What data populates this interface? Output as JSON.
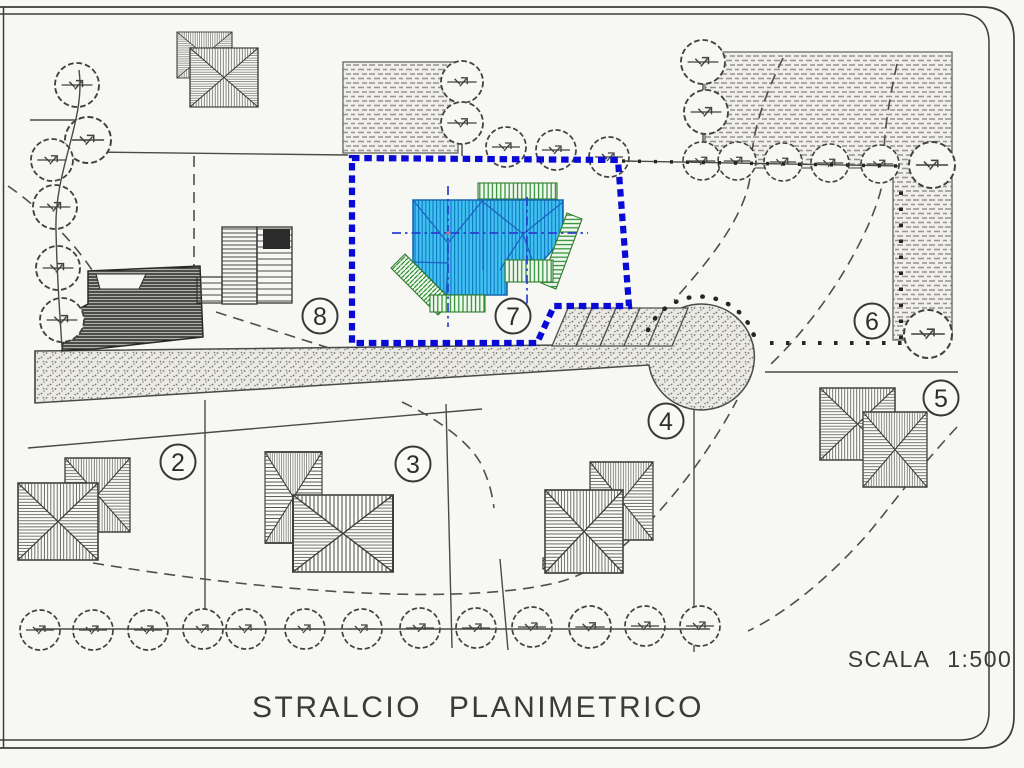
{
  "title": "STRALCIO PLANIMETRICO",
  "scale_label": "SCALA 1:500",
  "highlighted_lot": "7",
  "lots": [
    {
      "label": "2"
    },
    {
      "label": "3"
    },
    {
      "label": "4"
    },
    {
      "label": "5"
    },
    {
      "label": "6"
    },
    {
      "label": "7"
    },
    {
      "label": "8"
    }
  ],
  "colors": {
    "boundary_blue": "#0a0ad6",
    "roof_cyan": "#41c2f2",
    "roof_hatch_blue": "#1079c0",
    "terrace_green": "#2f8f33",
    "ink": "#3c3c3c",
    "paper": "#f7f7f4"
  }
}
